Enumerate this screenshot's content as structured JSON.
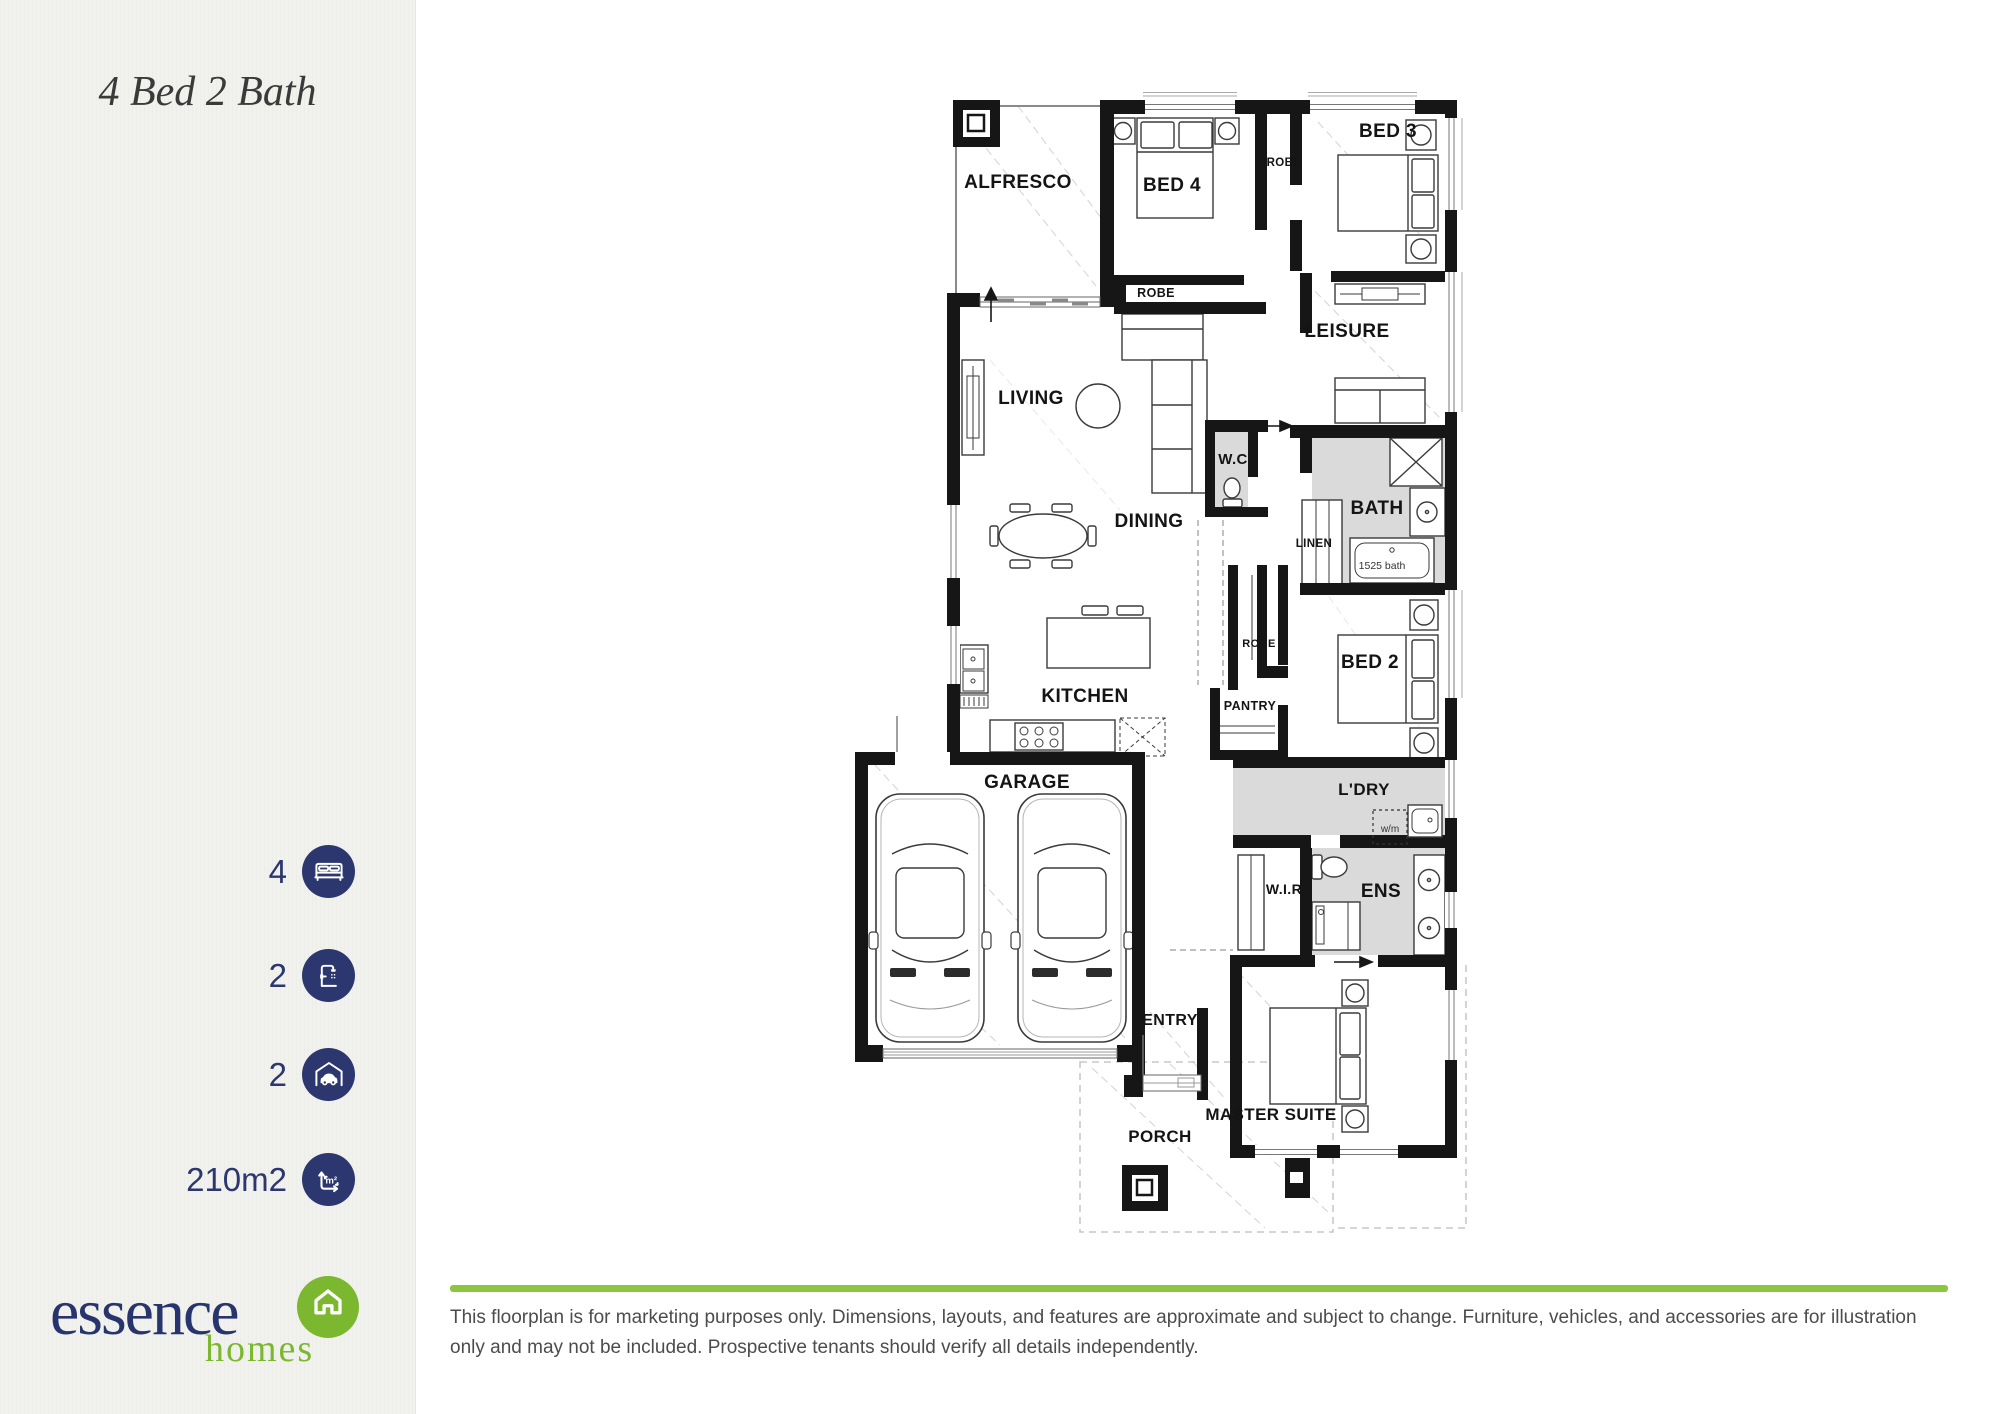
{
  "colors": {
    "navy": "#2b376e",
    "logo_navy": "#28356d",
    "logo_green": "#7cb82f",
    "bar_green": "#8cc63e",
    "wet_area_gray": "#dadada"
  },
  "sidebar": {
    "title": "4 Bed 2 Bath",
    "stats": [
      {
        "icon": "bed",
        "value": "4"
      },
      {
        "icon": "shower",
        "value": "2"
      },
      {
        "icon": "car",
        "value": "2"
      },
      {
        "icon": "area",
        "value": "210m2"
      }
    ],
    "area_glyph": "m²",
    "logo": {
      "primary": "essence",
      "secondary": "homes"
    }
  },
  "floorplan": {
    "labels": {
      "alfresco": "ALFRESCO",
      "bed4": "BED 4",
      "bed3": "BED 3",
      "robe_top": "ROBE",
      "robe_bed4": "ROBE",
      "leisure": "LEISURE",
      "living": "LIVING",
      "dining": "DINING",
      "wc": "W.C",
      "bath": "BATH",
      "linen": "LINEN",
      "bath_size": "1525 bath",
      "robe_bed2": "ROBE",
      "bed2": "BED 2",
      "kitchen": "KITCHEN",
      "pantry": "PANTRY",
      "garage": "GARAGE",
      "ldry": "L'DRY",
      "wm": "w/m",
      "wir": "W.I.R",
      "ens": "ENS",
      "entry": "ENTRY",
      "porch": "PORCH",
      "master": "MASTER SUITE"
    }
  },
  "footer": {
    "disclaimer": "This floorplan is for marketing purposes only. Dimensions, layouts, and features are approximate and subject to change. Furniture, vehicles, and accessories are for illustration only and may not be included. Prospective tenants should verify all details independently."
  }
}
